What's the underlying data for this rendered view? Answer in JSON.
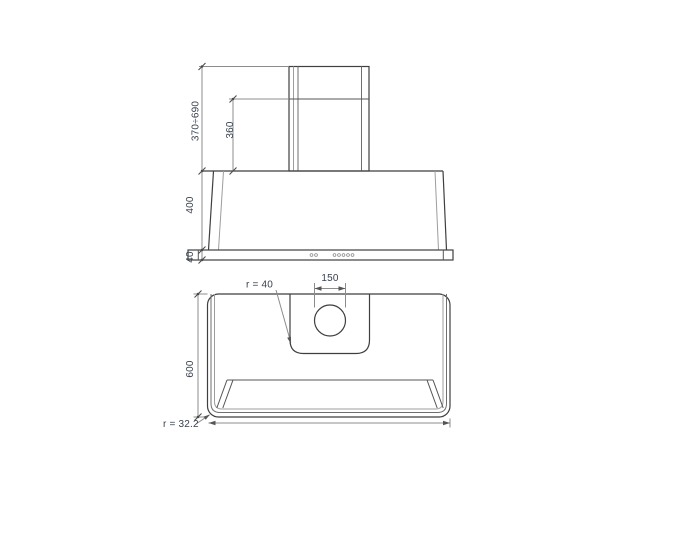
{
  "front_view": {
    "chimney_height_range": "370÷690",
    "chimney_section_height": "360",
    "canopy_height": "400",
    "base_band_height": "40"
  },
  "top_view": {
    "outlet_diameter": "150",
    "inner_corner_radius": "r = 40",
    "depth": "600",
    "outer_corner_radius": "r = 32.2"
  },
  "colors": {
    "background": "#ffffff",
    "outline": "#3f3f3f",
    "dimension_line": "#8c8c8c",
    "text": "#39414d"
  }
}
